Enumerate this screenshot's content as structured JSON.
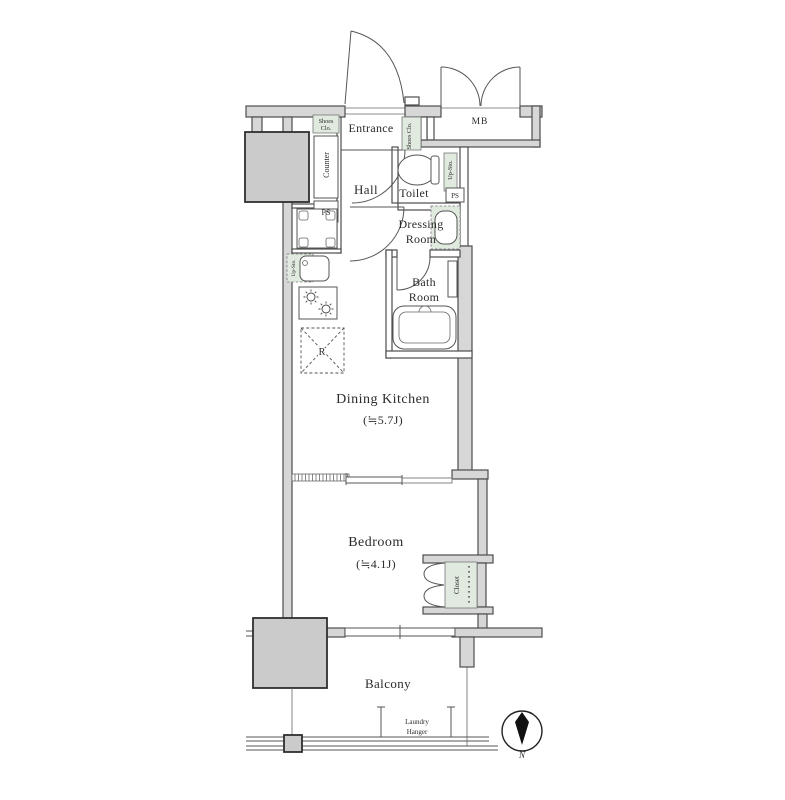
{
  "rooms": {
    "entrance": "Entrance",
    "hall": "Hall",
    "toilet": "Toilet",
    "dressing_room_line1": "Dressing",
    "dressing_room_line2": "Room",
    "bath_room_line1": "Bath",
    "bath_room_line2": "Room",
    "dining_kitchen": "Dining Kitchen",
    "dining_kitchen_size": "(≒5.7J)",
    "bedroom": "Bedroom",
    "bedroom_size": "(≒4.1J)",
    "balcony": "Balcony",
    "meter_box": "MB"
  },
  "storage": {
    "shoes_closet_left_line1": "Shoes",
    "shoes_closet_left_line2": "Clo.",
    "shoes_closet_right": "Shoes Clo.",
    "closet": "Closet",
    "upper_storage_toilet": "Up-Sto.",
    "upper_storage_kitchen": "Up-Sto."
  },
  "fixtures": {
    "counter": "Counter",
    "pipe_space_left": "PS",
    "pipe_space_right": "PS",
    "refrigerator_space": "R",
    "laundry_hanger_line1": "Laundry",
    "laundry_hanger_line2": "Hanger"
  },
  "compass": {
    "north": "N"
  },
  "colors": {
    "wall_fill": "#d7d7d7",
    "pillar_fill": "#cbcbcb",
    "fixture_green": "#e0eadf",
    "line": "#4d4d4d"
  }
}
